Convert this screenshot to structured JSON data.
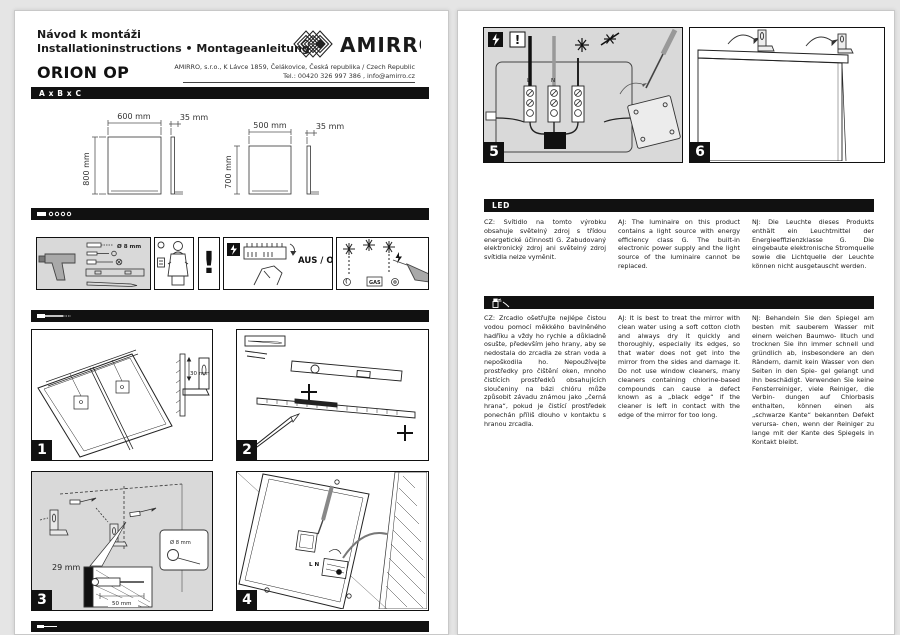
{
  "header": {
    "title_cz": "Návod k montáži",
    "title_intl": "Installationinstructions • Montageanleitung",
    "product_name": "ORION OP",
    "brand": "AMIRRO",
    "address": "AMIRRO, s.r.o., K Lávce 1859, Čelákovice, Česká republika / Czech Republic",
    "contact": "Tel.: 00420 326 997 386 , info@amirro.cz"
  },
  "bars": {
    "dimensions": "A x B x C",
    "led": "LED"
  },
  "diagrams": {
    "mirror1": {
      "width": "600 mm",
      "depth": "35 mm",
      "height": "800 mm"
    },
    "mirror2": {
      "width": "500 mm",
      "depth": "35 mm",
      "height": "700 mm"
    }
  },
  "pictograms": {
    "hole": "Ø 8 mm",
    "exclamation": "!",
    "power_off": "AUS / OFF",
    "gas": "GAS"
  },
  "steps": {
    "s1": {
      "num": "1",
      "bracket_offset": "30 mm"
    },
    "s2": {
      "num": "2"
    },
    "s3": {
      "num": "3",
      "offset": "29 mm",
      "hole": "Ø 8 mm",
      "depth": "50 mm"
    },
    "s4": {
      "num": "4",
      "terminals": "L N"
    },
    "s5": {
      "num": "5",
      "l": "L",
      "n": "N",
      "excl": "!"
    },
    "s6": {
      "num": "6"
    }
  },
  "led_section": {
    "cz": "CZ: Svítidlo na tomto výrobku obsahuje světelný zdroj s třídou energetické účinnosti G. Zabudovaný elektronický zdroj ani světelný zdroj svítidla nelze vyměnit.",
    "en": "AJ: The luminaire on this product contains a light source with energy efficiency class G. The built-in electronic power supply and the light source of the luminaire cannot be replaced.",
    "de": "NJ: Die Leuchte dieses Produkts enthält ein Leuchtmittel der Energieeffizienzklasse G. Die eingebaute elektronische Stromquelle sowie die Lichtquelle der Leuchte können nicht ausgetauscht werden."
  },
  "care_section": {
    "cz": "CZ: Zrcadlo ošetřujte nejlépe čistou vodou pomocí měkkého bavlněného hadříku a vždy ho rychle a důkladně osušte, především jeho hrany, aby se nedostala do zrcadla ze stran voda a nepoškodila ho. Nepoužívejte prostředky pro čištění oken, mnoho čistících prostředků obsahujících sloučeniny na bázi chlóru může způsobit závadu známou jako „černá hrana“, pokud je čistící prostředek ponechán příliš dlouho v kontaktu s hranou zrcadla.",
    "en": "AJ: It is best to treat the mirror with clean water using a soft cotton cloth and always dry it quickly and thoroughly, especially its edges, so that water does not get into the mirror from the sides and damage it. Do not use window cleaners, many cleaners containing chlorine-based compounds can cause a defect known as a „black edge“ if the cleaner is left in contact with the edge of the mirror for too long.",
    "de": "NJ: Behandeln Sie den Spiegel am besten mit sauberem Wasser mit einem weichen Baumwo- lltuch und trocknen Sie ihn immer schnell und gründlich ab, insbesondere an den Rändern, damit kein Wasser von den Seiten in den Spie- gel gelangt und ihn beschädigt. Verwenden Sie keine Fensterreiniger, viele Reiniger, die Verbin- dungen auf Chlorbasis enthalten, können einen als „schwarze Kante“ bekannten Defekt verursa- chen, wenn der Reiniger zu lange mit der Kante des Spiegels in Kontakt bleibt."
  },
  "colors": {
    "bar_black": "#111111",
    "panel_gray": "#d9d9d9",
    "page_white": "#ffffff",
    "canvas_gray": "#e5e5e5"
  }
}
